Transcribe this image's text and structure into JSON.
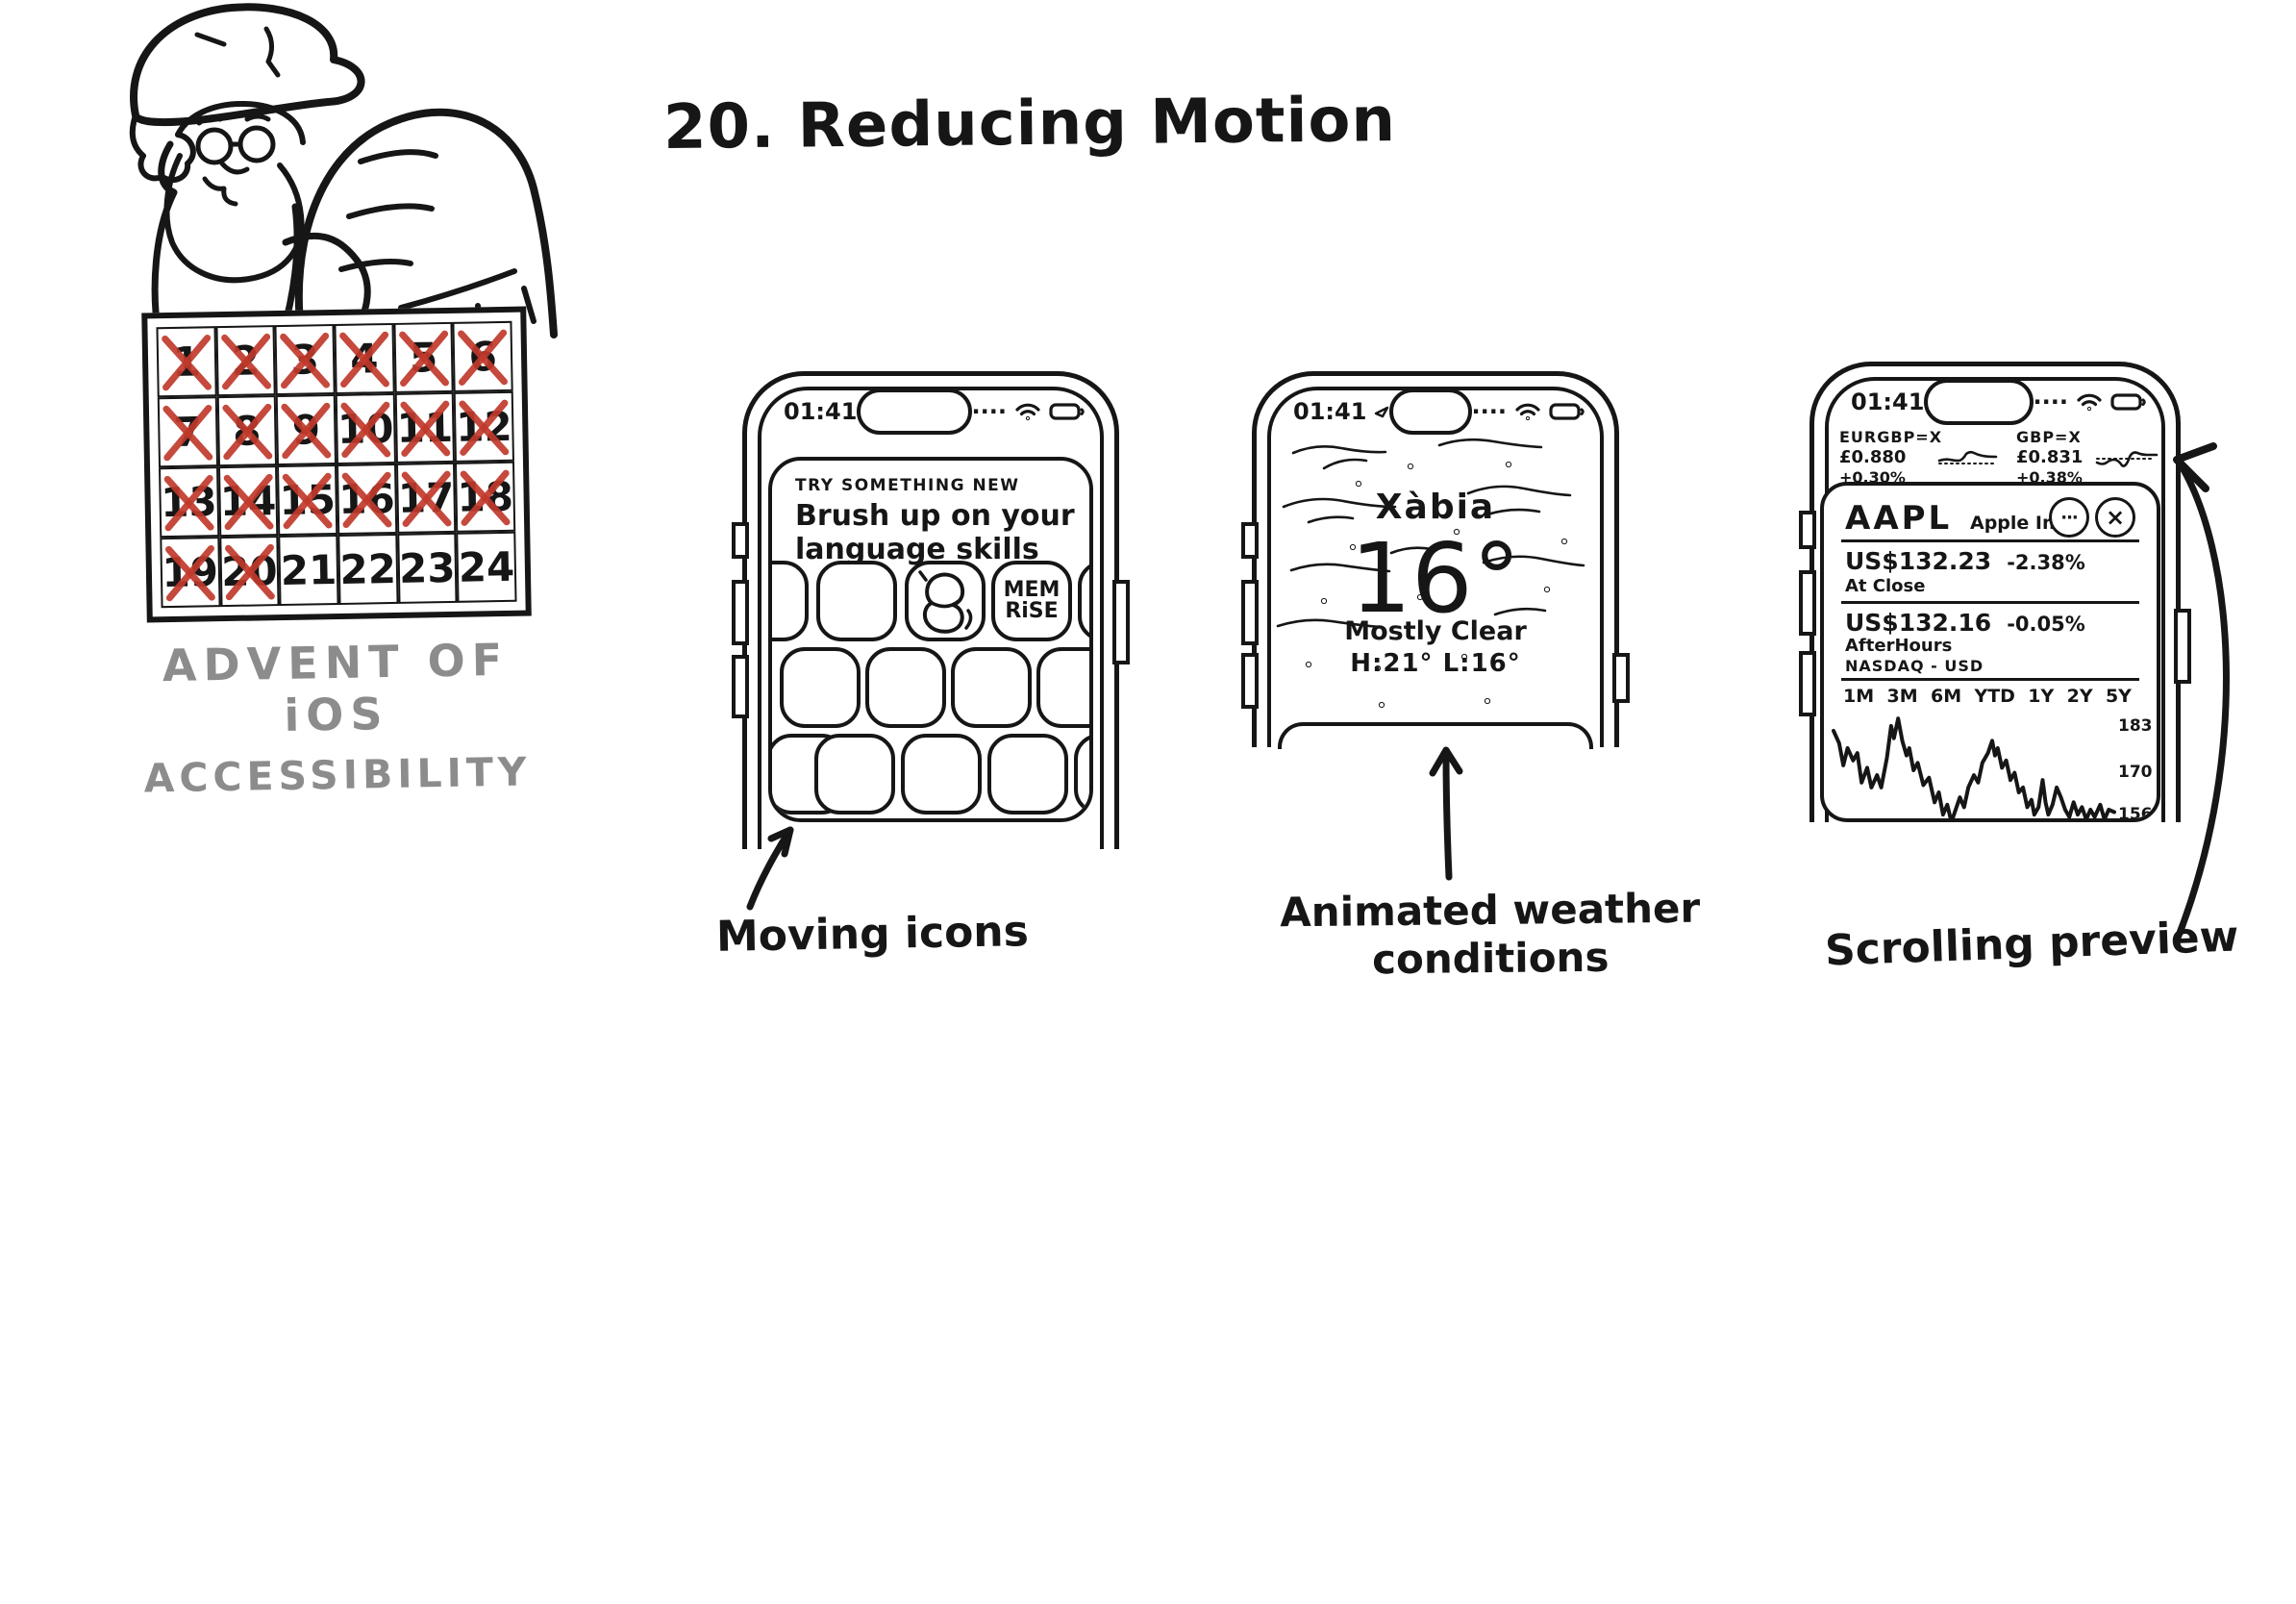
{
  "illustration": {
    "title": "20. Reducing Motion",
    "branding": {
      "line1": "ADVENT OF iOS",
      "line2": "ACCESSIBILITY"
    },
    "calendar": {
      "days": 24,
      "crossed_up_to": 20
    },
    "icons": {
      "cellular_dots": "····",
      "ellipsis": "···",
      "close": "×"
    },
    "phones": {
      "appstore": {
        "time": "01:41",
        "section_label": "TRY SOMETHING NEW",
        "headline": [
          "Brush up on your",
          "language skills"
        ],
        "memrise_icon": [
          "MEM",
          "RiSE"
        ],
        "caption": "Moving icons"
      },
      "weather": {
        "time": "01:41",
        "city": "Xàbia",
        "temperature": "16°",
        "condition": "Mostly Clear",
        "high_low": "H:21° L:16°",
        "caption": [
          "Animated weather",
          "conditions"
        ]
      },
      "stocks": {
        "time": "01:41",
        "tickers": [
          {
            "symbol": "EURGBP=X",
            "price": "£0.880",
            "change": "+0.30%"
          },
          {
            "symbol": "GBP=X",
            "price": "£0.831",
            "change": "+0.38%"
          }
        ],
        "stock": {
          "symbol": "AAPL",
          "company": "Apple Inc.",
          "close": {
            "price": "US$132.23",
            "change": "-2.38%",
            "label": "At Close"
          },
          "after_hours": {
            "price": "US$132.16",
            "change": "-0.05%",
            "label": "AfterHours"
          },
          "exchange": "NASDAQ - USD",
          "ranges": [
            "1M",
            "3M",
            "6M",
            "YTD",
            "1Y",
            "2Y",
            "5Y"
          ],
          "y_axis_labels": [
            "183",
            "170",
            "156"
          ]
        },
        "caption": "Scrolling preview"
      }
    },
    "colors": {
      "ink": "#161616",
      "cross_red": "#c0392b",
      "branding_gray": "#8c8c8c"
    },
    "chart_data": {
      "type": "line",
      "title": "AAPL Apple Inc. price sketch",
      "ylabel": "Price (USD)",
      "y_tick_labels": [
        183,
        170,
        156
      ],
      "y_max": 190,
      "y_min": 140,
      "legend": "none",
      "grid": false,
      "points": [
        [
          0,
          181
        ],
        [
          2,
          176
        ],
        [
          3.5,
          167
        ],
        [
          5,
          174
        ],
        [
          7,
          169
        ],
        [
          8.5,
          172
        ],
        [
          10,
          160
        ],
        [
          12,
          166
        ],
        [
          13.5,
          158
        ],
        [
          15.5,
          163
        ],
        [
          17,
          158
        ],
        [
          19,
          170
        ],
        [
          20.5,
          183
        ],
        [
          21.5,
          178
        ],
        [
          23,
          186
        ],
        [
          24.5,
          177
        ],
        [
          26,
          171
        ],
        [
          27,
          174
        ],
        [
          28.5,
          165
        ],
        [
          30,
          168
        ],
        [
          32,
          159
        ],
        [
          34,
          162
        ],
        [
          36,
          152
        ],
        [
          37.5,
          156
        ],
        [
          39,
          147
        ],
        [
          40.5,
          151
        ],
        [
          42,
          144
        ],
        [
          43.5,
          149
        ],
        [
          45,
          154
        ],
        [
          46.5,
          150
        ],
        [
          48,
          158
        ],
        [
          50,
          163
        ],
        [
          51.5,
          160
        ],
        [
          53,
          168
        ],
        [
          55,
          172
        ],
        [
          56.5,
          177
        ],
        [
          57.5,
          171
        ],
        [
          58.5,
          174
        ],
        [
          60,
          166
        ],
        [
          61.5,
          169
        ],
        [
          63,
          161
        ],
        [
          64.5,
          164
        ],
        [
          66,
          156
        ],
        [
          67.5,
          158
        ],
        [
          69,
          150
        ],
        [
          70.5,
          153
        ],
        [
          71.5,
          147
        ],
        [
          73,
          150
        ],
        [
          74.5,
          161
        ],
        [
          75.5,
          152
        ],
        [
          76.5,
          147
        ],
        [
          78,
          151
        ],
        [
          79.5,
          158
        ],
        [
          81,
          154
        ],
        [
          82.5,
          149
        ],
        [
          84,
          146
        ],
        [
          85.5,
          152
        ],
        [
          87,
          147
        ],
        [
          88.5,
          150
        ],
        [
          90,
          145
        ],
        [
          91.5,
          149
        ],
        [
          93,
          146
        ],
        [
          95,
          151
        ],
        [
          96.5,
          145
        ],
        [
          98,
          149
        ],
        [
          100,
          148
        ]
      ]
    }
  }
}
